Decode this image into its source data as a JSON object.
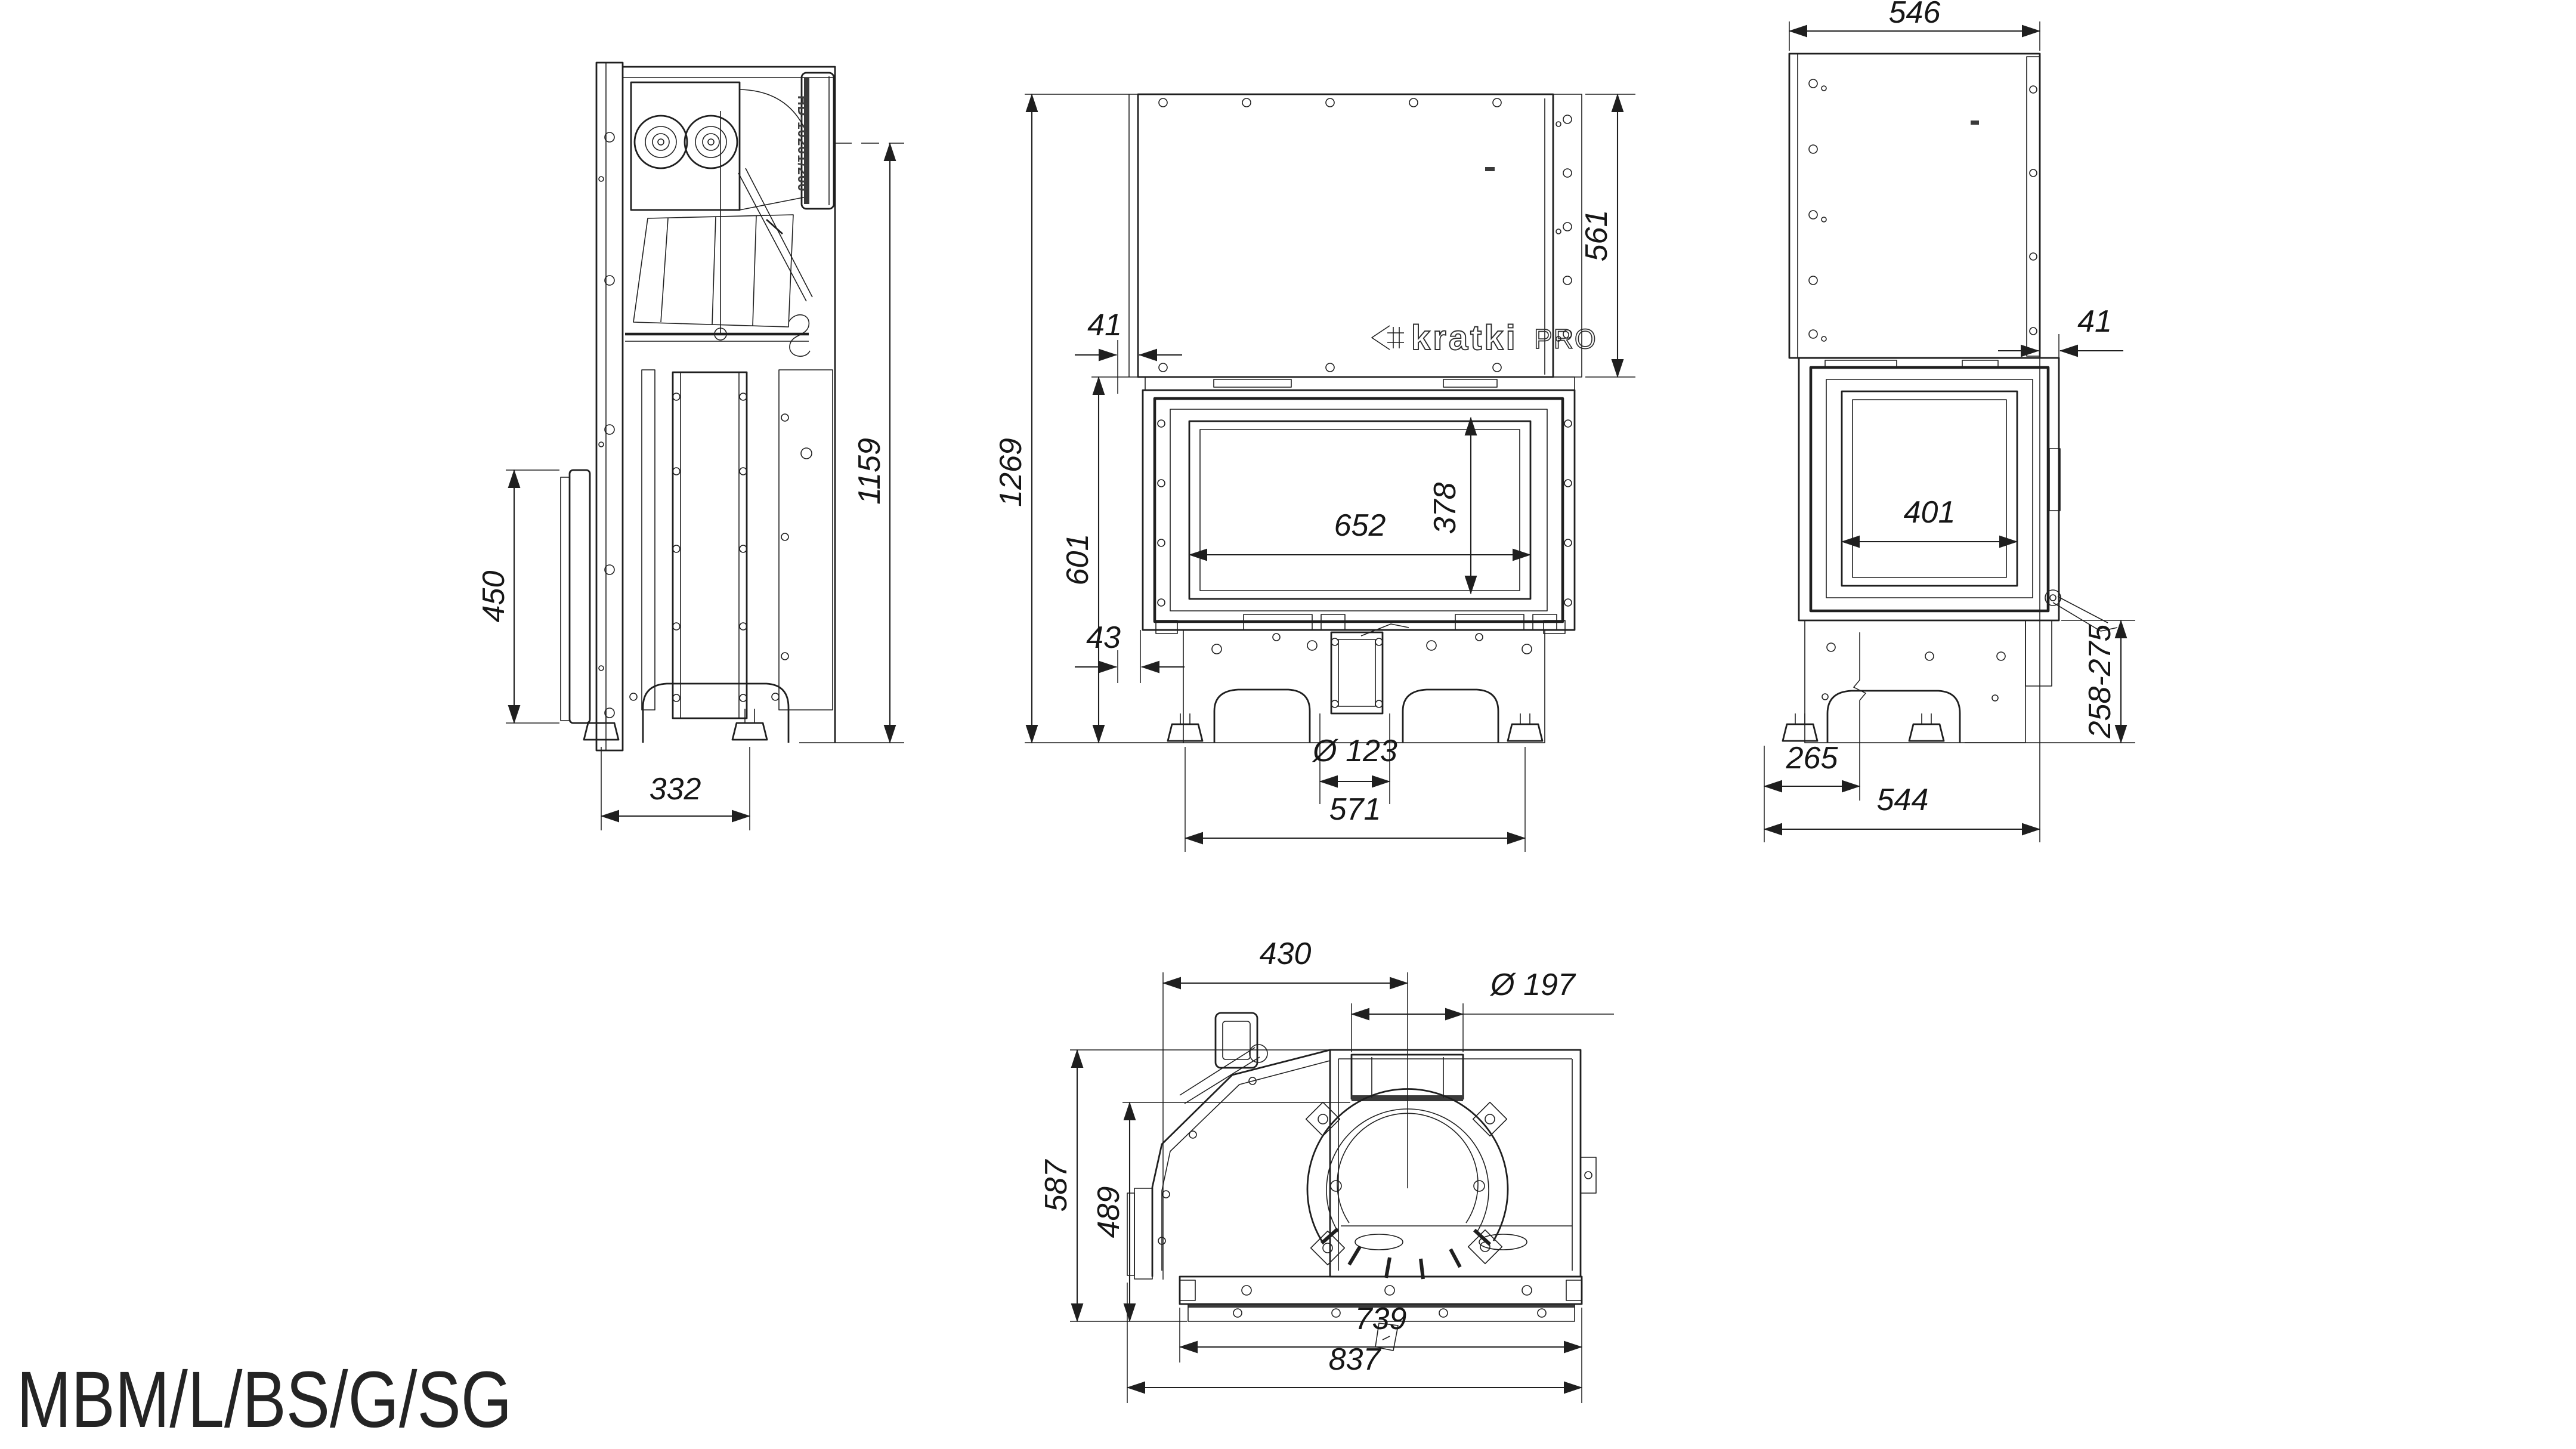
{
  "drawing": {
    "model_label": "MBM/L/BS/G/SG",
    "brand": {
      "logo_text": "kratki",
      "logo_suffix": "PRO"
    },
    "colors": {
      "line": "#1f1f1f",
      "background": "#ffffff"
    },
    "views": {
      "left_side": {
        "part_label": "HD-10201/200",
        "dimensions": {
          "door_height": "450",
          "overall_height": "1159",
          "feet_spacing": "332"
        }
      },
      "front": {
        "dimensions": {
          "left_offset_top": "41",
          "overall_height": "1269",
          "body_height": "601",
          "left_offset_bottom": "43",
          "glass_width": "652",
          "glass_height": "378",
          "upper_panel_height": "561",
          "flue_pipe_diameter": "Ø 123",
          "feet_spacing": "571"
        }
      },
      "right_side": {
        "dimensions": {
          "depth_top": "546",
          "front_offset_top": "41",
          "glass_width": "401",
          "base_height_range": "258-275",
          "center_offset": "265",
          "overall_depth": "544"
        }
      },
      "top": {
        "dimensions": {
          "flue_center_from_left": "430",
          "flue_diameter": "Ø 197",
          "overall_depth": "587",
          "inner_depth": "489",
          "front_bar_width": "739",
          "overall_width": "837"
        }
      }
    }
  }
}
